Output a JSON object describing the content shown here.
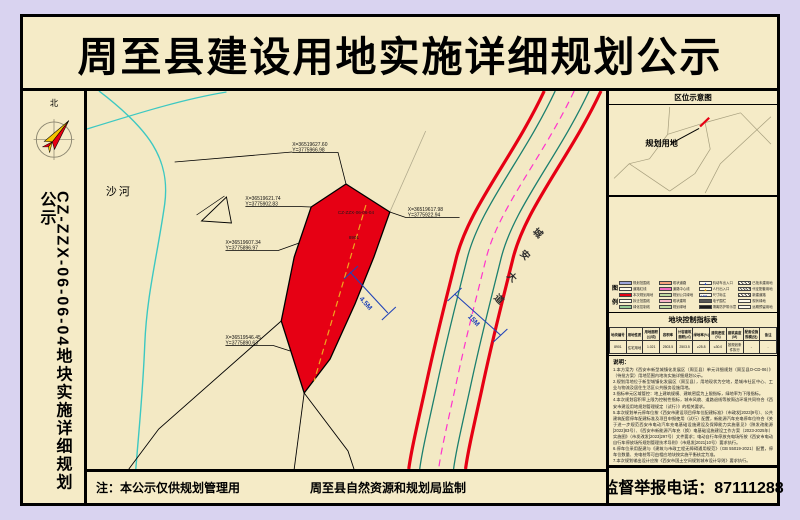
{
  "title": "周至县建设用地实施详细规划公示",
  "sidebar": {
    "north_label": "北",
    "plot_code_vertical": "CZ-ZZX-06-06-04地块实施详细规划公示"
  },
  "map": {
    "river_label": "沙河",
    "parcel_code": "CZ-ZZX-06-06-04",
    "parcel_no": "8901",
    "road_name": "城安大道",
    "dim1": "4.5M",
    "dim2": "15M",
    "coords": [
      {
        "x": "X=36519627.60",
        "y": "Y=3775966.98"
      },
      {
        "x": "X=36519621.74",
        "y": "Y=3775902.83"
      },
      {
        "x": "X=36519617.98",
        "y": "Y=3775922.94"
      },
      {
        "x": "X=36519607.34",
        "y": "Y=3775896.97"
      },
      {
        "x": "X=36519546.45",
        "y": "Y=3775890.63"
      }
    ]
  },
  "right_panel": {
    "location_map_title": "区位示意图",
    "location_map_label": "规划用地",
    "legend_title": "图例",
    "legend_items": [
      "规划范围线",
      "道路红线",
      "本次规划用地",
      "拆迁范围线",
      "绿化控制线",
      "现状道路",
      "道路中心线",
      "规划公共绿地",
      "现状建筑",
      "规划绿地",
      "机动车出入口",
      "人行出入口",
      "尺寸标注",
      "电子围栏",
      "隔离防护带示意",
      "已批未建用地",
      "代征配套用地",
      "新建道路",
      "现状绿地",
      "远期预留用地"
    ],
    "table": {
      "title": "地块控制指标表",
      "headers": [
        "地块编号",
        "用地性质",
        "用地面积(公顷)",
        "容积率",
        "计容建筑面积(㎡)",
        "绿地率(%)",
        "建筑密度(%)",
        "建筑高度(M)",
        "配套设施规模(处)",
        "备注"
      ],
      "row": [
        "8901",
        "住宅用地",
        "1.021",
        "2503.5",
        "2503.5",
        "≥25.8",
        "≤30.0",
        "按规划条件执行",
        "-",
        "-"
      ]
    },
    "notes_title": "说明：",
    "notes": [
      "1.本方案为《西安市新型城镇化发展区（周至县）单元详细规划（周至县O-CD-06）》（待批方案）用地范围内地块实施详细规划公示。",
      "2.规划用地位于新型城镇化发展区（周至县），用地现状为空地，是城市社区中心、工业与物流及居住生活区公共服务设施用地。",
      "3.指标单元区域管控：地上建筑规模、建筑密度为上限指标，绿地率为下限指标。",
      "4.本次规划容积率上限为控制性指标，城市风貌、道路退线等按周边环境共同符合《西安市建设用地规划管理规定（试行）》的相关要求。",
      "5.本次规划单元停车位按《西安市建设项目停车位配建标准》（市政发[2023]9号）、公共建筑配套停车配建标准及项目申报使用（试行）配置，新能源汽车充电停车位符合《关于进一步规范西安市电动汽车充电基础设施建设及保障能力实施意见》（陕发改能源[2022]83号）、《西安市新能源汽车充（换）电基础设施建设工作方案（2023-2025年）实施图》（市发改发[2023]297号）文件要求；电动自行车停放充电场所按《西安市电动自行车停放场所规划管理技术导则》（市规发[2021]10号）要求执行。",
      "6.停车位采用配建与《建筑与市政工程无障碍通用规范》（GB 55019-2021）配置，停车位数量、充电桩等可由相应地块按实施平衡核定为准。",
      "7.本次规划输出设计应按《西安市国土空间规划城市设计导则》要求执行。",
      "8.本次规划成果自公示之日起按《西安市国土空间详细规划管理办法（试行）》要求执行。",
      "9.规划用地块附条件以实施成熟为准，且应按照《西安市建设项目实施规划成果纳入》及《西安市勘测成果有效规划手续成果》执行为准。",
      "10.本次规划期中项目规划建筑依据影像覆盖及2023年10月1日现场确认依据进行核准。",
      "11.本图坐标采用西安2000坐标系。"
    ]
  },
  "footer": {
    "note": "注：本公示仅供规划管理用",
    "producer": "周至县自然资源和规划局监制",
    "hotline": "监督举报电话：87111288"
  },
  "theme": {
    "accent_red": "#e60014",
    "river_teal": "#3cc8c2",
    "road_green": "#1b7f6e",
    "magenta": "#ff33cc",
    "dash_yellow": "#f0a71f",
    "dim_blue": "#2143b8",
    "panel_beige": "#f5ebc7",
    "margin_lavender": "#d9d3f0"
  }
}
